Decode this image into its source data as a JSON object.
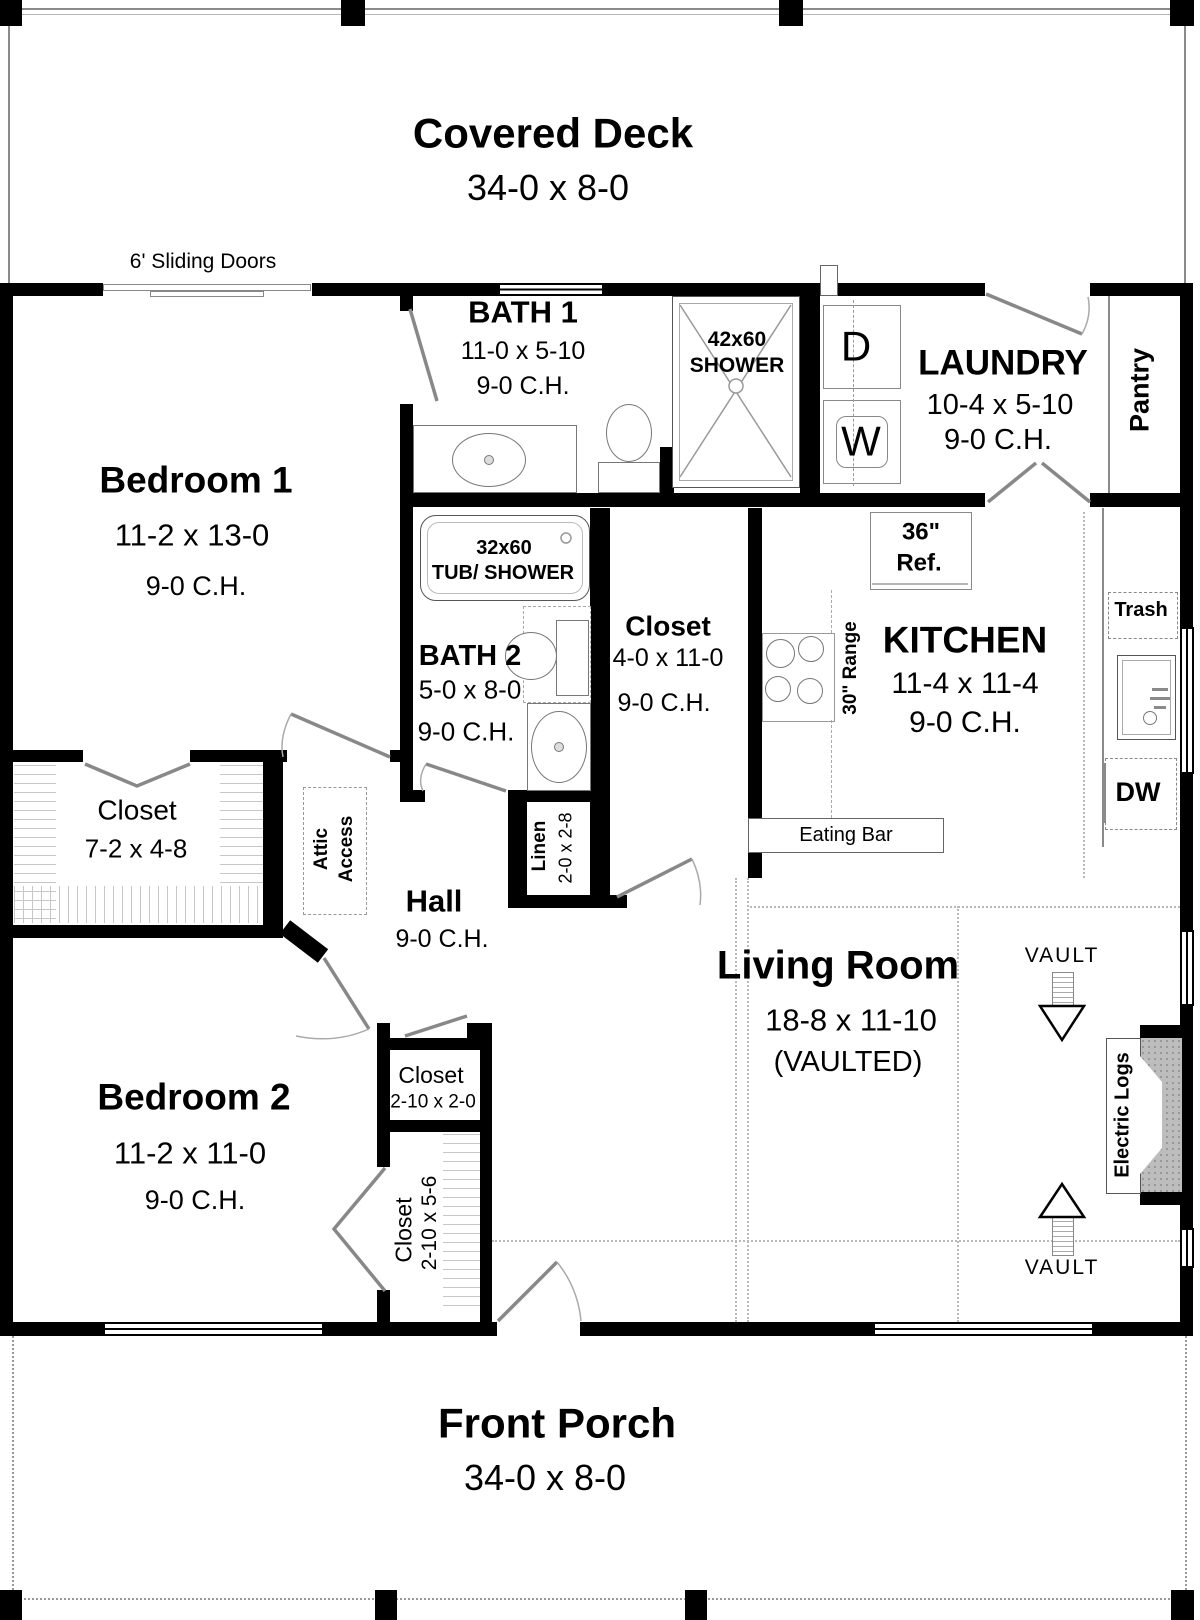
{
  "deck": {
    "title": "Covered Deck",
    "dims": "34-0 x 8-0",
    "sliding_doors": "6' Sliding Doors"
  },
  "rooms": {
    "bedroom1": {
      "name": "Bedroom 1",
      "dims": "11-2 x 13-0",
      "ceiling": "9-0 C.H."
    },
    "bath1": {
      "name": "BATH 1",
      "dims": "11-0 x 5-10",
      "ceiling": "9-0 C.H."
    },
    "shower": {
      "size": "42x60",
      "label": "SHOWER"
    },
    "laundry": {
      "name": "LAUNDRY",
      "dims": "10-4 x 5-10",
      "ceiling": "9-0 C.H.",
      "dryer": "D",
      "washer": "W"
    },
    "pantry": {
      "name": "Pantry"
    },
    "bath2": {
      "name": "BATH 2",
      "dims": "5-0 x 8-0",
      "ceiling": "9-0 C.H.",
      "tub_size": "32x60",
      "tub_label": "TUB/ SHOWER"
    },
    "hall_closet": {
      "name": "Closet",
      "dims": "4-0 x 11-0",
      "ceiling": "9-0 C.H."
    },
    "kitchen": {
      "name": "KITCHEN",
      "dims": "11-4 x 11-4",
      "ceiling": "9-0 C.H.",
      "fridge_size": "36\"",
      "fridge": "Ref.",
      "range": "30\" Range",
      "trash": "Trash",
      "dishwasher": "DW",
      "eating_bar": "Eating Bar"
    },
    "bedroom1_closet": {
      "name": "Closet",
      "dims": "7-2 x 4-8"
    },
    "attic": {
      "line1": "Attic",
      "line2": "Access"
    },
    "hall": {
      "name": "Hall",
      "ceiling": "9-0 C.H."
    },
    "linen": {
      "name": "Linen",
      "dims": "2-0 x 2-8"
    },
    "living": {
      "name": "Living Room",
      "dims": "18-8 x 11-10",
      "note": "(VAULTED)",
      "vault": "VAULT",
      "fireplace": "Electric Logs"
    },
    "bedroom2": {
      "name": "Bedroom 2",
      "dims": "11-2 x 11-0",
      "ceiling": "9-0 C.H."
    },
    "closet_small": {
      "name": "Closet",
      "dims": "2-10 x 2-0"
    },
    "closet_tall": {
      "name": "Closet",
      "dims": "2-10 x 5-6"
    }
  },
  "porch": {
    "title": "Front Porch",
    "dims": "34-0 x 8-0"
  },
  "colors": {
    "wall": "#000000",
    "line": "#888888",
    "fireplace_gray": "#bdbdbd"
  }
}
